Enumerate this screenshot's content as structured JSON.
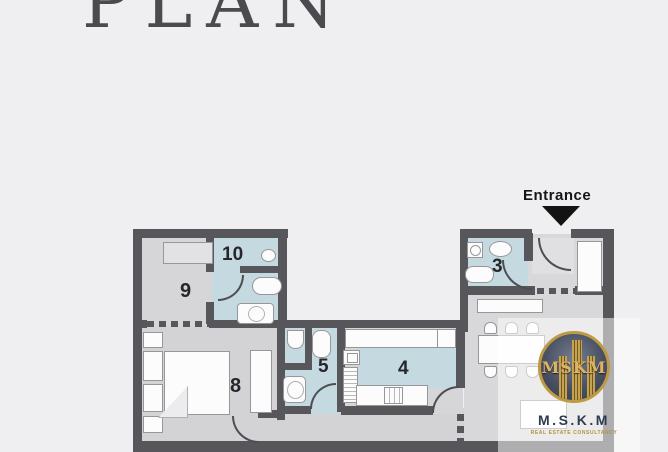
{
  "title": {
    "text": "PLAN"
  },
  "entrance": {
    "label": "Entrance"
  },
  "rooms": {
    "r3": "3",
    "r4": "4",
    "r5": "5",
    "r8": "8",
    "r9": "9",
    "r10": "10"
  },
  "logo": {
    "emblem": "MSKM",
    "name": "M.S.K.M",
    "tagline": "REAL ESTATE CONSULTANCY"
  },
  "colors": {
    "background": "#efeff1",
    "wall": "#57575b",
    "floor": "#d6d6d8",
    "wet_room_blue": "#c5d9e0",
    "fixture_white": "#fcfcfc",
    "title_text": "#4a4a4f",
    "room_label_text": "#26262b",
    "entrance_text": "#151515",
    "logo_gold": "#bf9a44",
    "logo_navy": "#2e3b50"
  },
  "icons": {
    "entrance_arrow": "triangle-down"
  }
}
